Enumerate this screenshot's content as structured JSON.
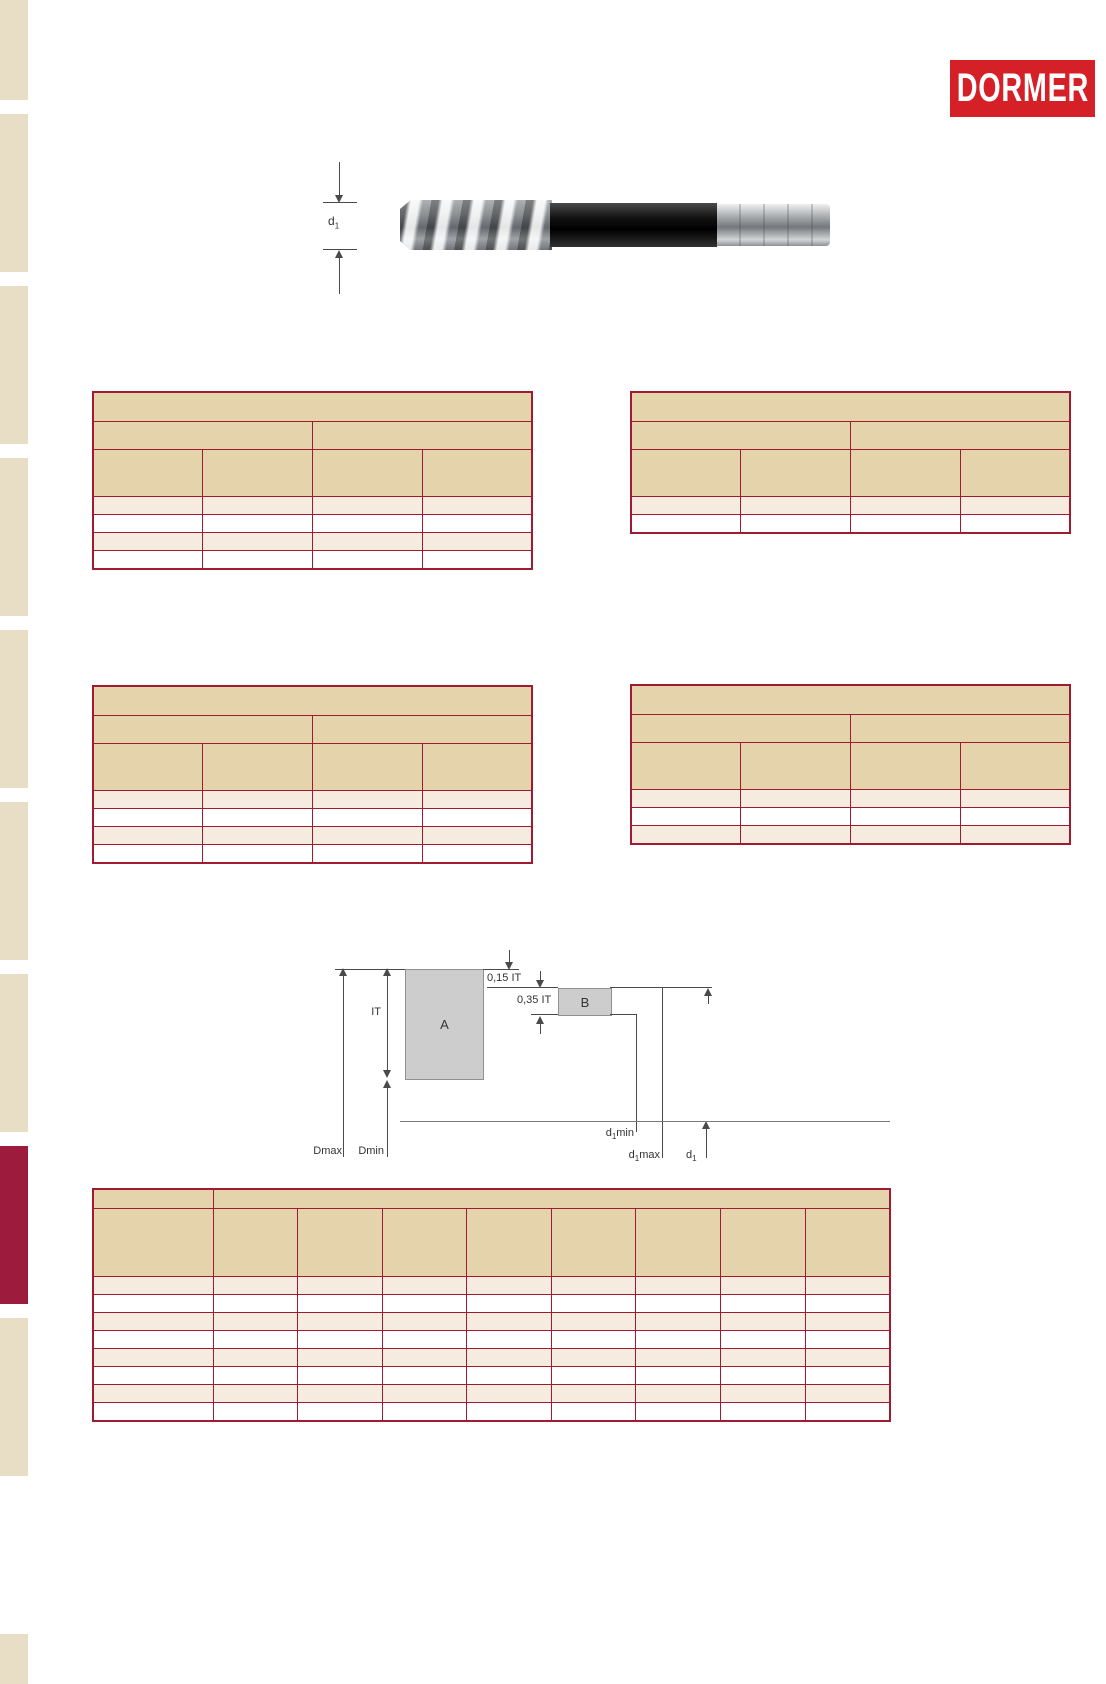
{
  "brand": {
    "logo_text": "DORMER",
    "logo_bg": "#d52027"
  },
  "reamer_figure": {
    "diameter_label_base": "d",
    "diameter_label_sub": "1"
  },
  "tolerance_diagram": {
    "label_it": "IT",
    "label_zone_a": "A",
    "label_zone_b": "B",
    "label_015": "0,15 IT",
    "label_035": "0,35 IT",
    "label_dmax": "Dmax",
    "label_dmin": "Dmin",
    "label_d1min_base": "d",
    "label_d1min_sub": "1",
    "label_d1min_suffix": "min",
    "label_d1max_base": "d",
    "label_d1max_sub": "1",
    "label_d1max_suffix": "max",
    "label_d1_base": "d",
    "label_d1_sub": "1",
    "zone_fill": "#cdcdcd",
    "zone_border": "#909090"
  },
  "colors": {
    "table_border": "#9e1b32",
    "header_fill": "#e5d3ab",
    "row_alt_fill": "#f5ecdf",
    "row_fill": "#ffffff",
    "sidebar_fill": "#e8dec6",
    "sidebar_accent": "#9d1b3d"
  },
  "spec_tables": {
    "top_left": {
      "columns": 4,
      "data_rows": 4
    },
    "top_right": {
      "columns": 4,
      "data_rows": 2
    },
    "mid_left": {
      "columns": 4,
      "data_rows": 4
    },
    "mid_right": {
      "columns": 4,
      "data_rows": 3
    },
    "tolerance_table": {
      "columns": 9,
      "data_rows": 8
    }
  }
}
